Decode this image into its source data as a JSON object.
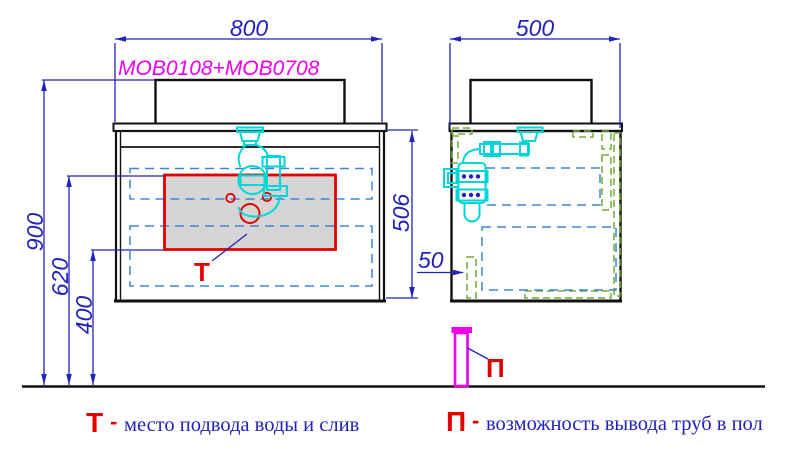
{
  "drawing": {
    "model_code": "MOB0108+MOB0708",
    "front_view": {
      "dim_width": "800",
      "dim_height_total": "900",
      "dim_drain_zone_top": "620",
      "dim_drain_zone_bottom": "400",
      "drain_zone_label": "Т"
    },
    "side_view": {
      "dim_depth": "500",
      "dim_cabinet_height": "506",
      "dim_back_offset": "50",
      "floor_pipe_label": "П"
    },
    "legend": {
      "t_symbol": "Т",
      "t_separator": "-",
      "t_description": "место подвода воды и слив",
      "p_symbol": "П",
      "p_separator": "-",
      "p_description": "возможность вывода труб в пол"
    },
    "colors": {
      "dimension_blue": "#2222bb",
      "dashed_blue": "#3f85d6",
      "siphon_cyan": "#00d6d6",
      "accent_red": "#e50000",
      "hatch_green": "#72ad35",
      "pipe_magenta": "#ee00ee",
      "outline_black": "#111111",
      "zone_gray": "#d5d5d5"
    }
  }
}
